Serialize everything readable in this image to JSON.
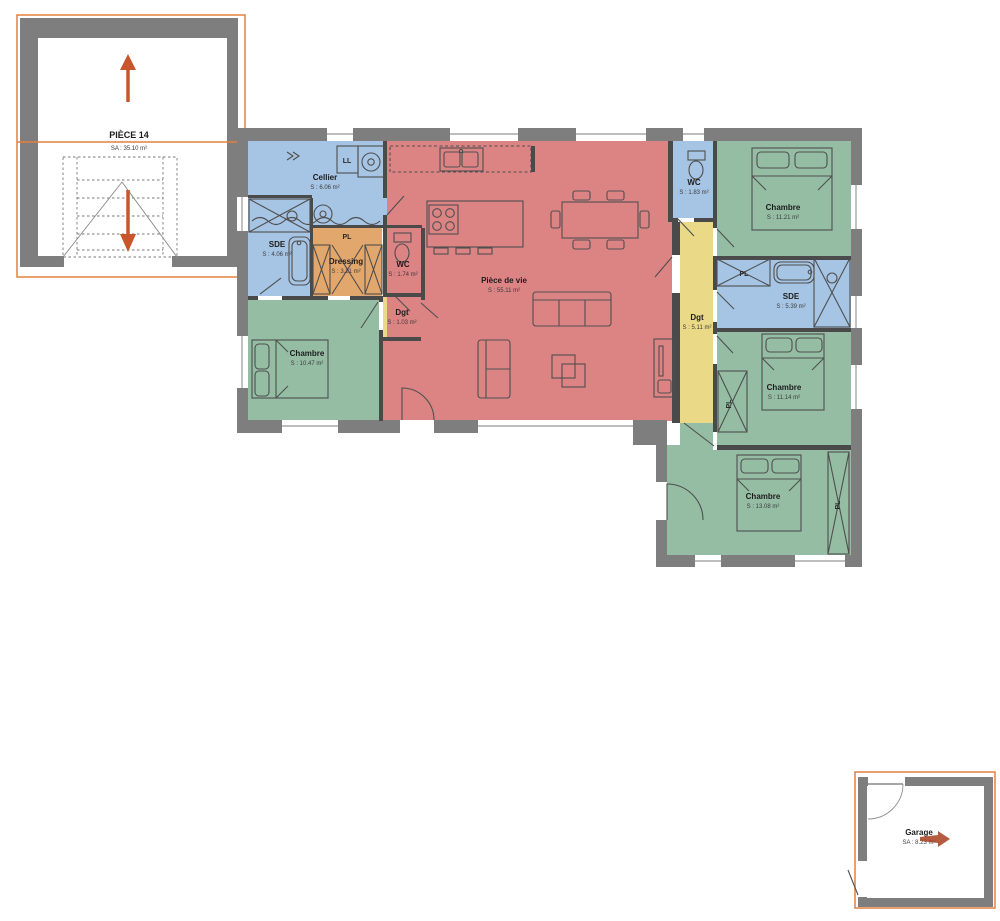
{
  "colors": {
    "wall": "#7e7e7e",
    "inner_wall": "#4a4a4a",
    "water_room": "#a6c4e3",
    "bedroom": "#95bda4",
    "living": "#dc8384",
    "circulation": "#ead987",
    "dressing": "#e2a76c",
    "accent_orange": "#e2813f",
    "arrow": "#c8552b",
    "garage_arrow": "#a8401f"
  },
  "annex": {
    "name": "PIÈCE 14",
    "area": "SA : 35.10 m²"
  },
  "garage": {
    "name": "Garage",
    "area": "SA : 8.23 m²"
  },
  "rooms": {
    "cellier": {
      "name": "Cellier",
      "area": "S : 6.06 m²"
    },
    "sde1": {
      "name": "SDE",
      "area": "S : 4.06 m²"
    },
    "dressing": {
      "name": "Dressing",
      "area": "S : 3.21 m²"
    },
    "wc1": {
      "name": "WC",
      "area": "S : 1.74 m²"
    },
    "dgt1": {
      "name": "Dgt",
      "area": "S : 1.03 m²"
    },
    "chambre1": {
      "name": "Chambre",
      "area": "S : 10.47 m²"
    },
    "piece_de_vie": {
      "name": "Pièce de vie",
      "area": "S : 55.11 m²"
    },
    "wc2": {
      "name": "WC",
      "area": "S : 1.83 m²"
    },
    "chambre2": {
      "name": "Chambre",
      "area": "S : 11.21 m²"
    },
    "sde2": {
      "name": "SDE",
      "area": "S : 5.39 m²"
    },
    "dgt2": {
      "name": "Dgt",
      "area": "S : 5.11 m²"
    },
    "chambre3": {
      "name": "Chambre",
      "area": "S : 11.14 m²"
    },
    "chambre4": {
      "name": "Chambre",
      "area": "S : 13.08 m²"
    }
  },
  "fixtures": {
    "closet": "PL",
    "washing_machine": "LL"
  }
}
